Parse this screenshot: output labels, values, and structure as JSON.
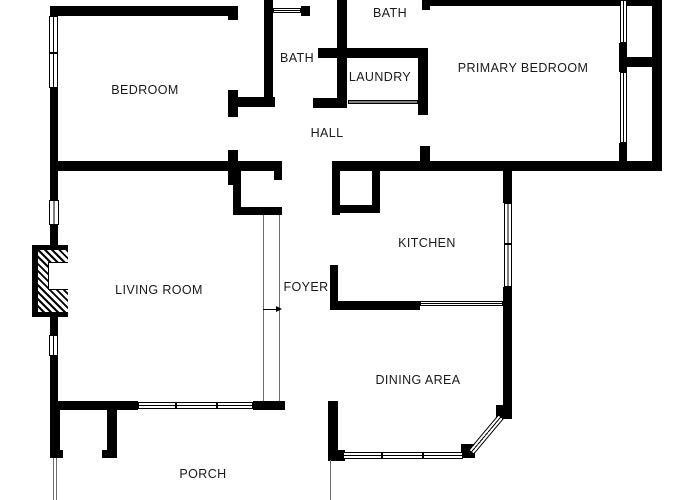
{
  "floorplan": {
    "canvas": {
      "width": 700,
      "height": 500,
      "background": "#ffffff",
      "wall_color": "#000000",
      "label_color": "#1a1a1a"
    },
    "rooms": [
      {
        "id": "bedroom",
        "label": "BEDROOM",
        "x": 145,
        "y": 90
      },
      {
        "id": "bath-hall",
        "label": "BATH",
        "x": 297,
        "y": 58
      },
      {
        "id": "bath-primary",
        "label": "BATH",
        "x": 390,
        "y": 13
      },
      {
        "id": "laundry",
        "label": "LAUNDRY",
        "x": 380,
        "y": 77
      },
      {
        "id": "primary-bedroom",
        "label": "PRIMARY BEDROOM",
        "x": 523,
        "y": 68
      },
      {
        "id": "hall",
        "label": "HALL",
        "x": 327,
        "y": 133
      },
      {
        "id": "kitchen",
        "label": "KITCHEN",
        "x": 427,
        "y": 243
      },
      {
        "id": "living-room",
        "label": "LIVING ROOM",
        "x": 159,
        "y": 290
      },
      {
        "id": "foyer",
        "label": "FOYER",
        "x": 306,
        "y": 287
      },
      {
        "id": "dining-area",
        "label": "DINING AREA",
        "x": 418,
        "y": 380
      },
      {
        "id": "porch",
        "label": "PORCH",
        "x": 203,
        "y": 474
      }
    ],
    "walls": [
      [
        50,
        6,
        188,
        10
      ],
      [
        228,
        10,
        10,
        10
      ],
      [
        50,
        88,
        8,
        76
      ],
      [
        50,
        161,
        232,
        10
      ],
      [
        50,
        171,
        8,
        29
      ],
      [
        50,
        225,
        8,
        22
      ],
      [
        50,
        315,
        8,
        20
      ],
      [
        50,
        356,
        8,
        49
      ],
      [
        228,
        150,
        10,
        35
      ],
      [
        264,
        0,
        9,
        103
      ],
      [
        301,
        6,
        9,
        10
      ],
      [
        337,
        0,
        10,
        108
      ],
      [
        318,
        48,
        107,
        10
      ],
      [
        313,
        98,
        34,
        10
      ],
      [
        233,
        97,
        42,
        10
      ],
      [
        228,
        90,
        10,
        27
      ],
      [
        418,
        48,
        10,
        67
      ],
      [
        422,
        0,
        8,
        10
      ],
      [
        420,
        146,
        10,
        25
      ],
      [
        332,
        161,
        330,
        10
      ],
      [
        427,
        0,
        235,
        6
      ],
      [
        652,
        0,
        10,
        171
      ],
      [
        625,
        57,
        37,
        10
      ],
      [
        619,
        43,
        8,
        29
      ],
      [
        619,
        143,
        8,
        28
      ],
      [
        233,
        171,
        8,
        44
      ],
      [
        233,
        207,
        49,
        8
      ],
      [
        274,
        168,
        8,
        12
      ],
      [
        332,
        171,
        8,
        44
      ],
      [
        372,
        165,
        8,
        48
      ],
      [
        332,
        205,
        48,
        8
      ],
      [
        330,
        265,
        8,
        45
      ],
      [
        330,
        301,
        90,
        9
      ],
      [
        503,
        163,
        9,
        40
      ],
      [
        503,
        287,
        9,
        128
      ],
      [
        328,
        401,
        10,
        60
      ],
      [
        336,
        450,
        9,
        11
      ],
      [
        50,
        401,
        88,
        9
      ],
      [
        253,
        401,
        32,
        9
      ],
      [
        107,
        402,
        10,
        56
      ],
      [
        50,
        405,
        10,
        53
      ],
      [
        50,
        450,
        13,
        8
      ],
      [
        102,
        450,
        15,
        8
      ],
      [
        461,
        444,
        14,
        14
      ],
      [
        496,
        405,
        16,
        14
      ]
    ],
    "windows": [
      {
        "x": 49,
        "y": 16,
        "w": 9,
        "h": 72,
        "dy": [
          52
        ],
        "dx": []
      },
      {
        "x": 49,
        "y": 200,
        "w": 10,
        "h": 25,
        "dy": [],
        "dx": []
      },
      {
        "x": 49,
        "y": 335,
        "w": 9,
        "h": 21,
        "dy": [],
        "dx": []
      },
      {
        "x": 504,
        "y": 203,
        "w": 8,
        "h": 84,
        "dy": [
          243
        ],
        "dx": []
      },
      {
        "x": 620,
        "y": 0,
        "w": 7,
        "h": 43,
        "dy": [],
        "dx": []
      },
      {
        "x": 620,
        "y": 72,
        "w": 7,
        "h": 71,
        "dy": [],
        "dx": []
      },
      {
        "x": 138,
        "y": 402,
        "w": 115,
        "h": 7,
        "dy": [],
        "dx": [
          175,
          216
        ]
      },
      {
        "x": 343,
        "y": 452,
        "w": 120,
        "h": 7,
        "dy": [],
        "dx": [
          381,
          422
        ]
      },
      {
        "x": 273,
        "y": 8,
        "w": 28,
        "h": 5,
        "dy": [],
        "dx": []
      },
      {
        "x": 348,
        "y": 100,
        "w": 70,
        "h": 4,
        "dy": [],
        "dx": []
      },
      {
        "x": 420,
        "y": 301,
        "w": 83,
        "h": 5,
        "dy": [],
        "dx": []
      }
    ],
    "bay_window": {
      "x": 471,
      "y": 449,
      "length": 47,
      "thickness": 7,
      "angle": -50
    },
    "rails": [
      {
        "x": 263,
        "y": 215,
        "len": 186
      },
      {
        "x": 279,
        "y": 215,
        "len": 186
      },
      {
        "x": 53,
        "y": 458,
        "len": 42
      },
      {
        "x": 56,
        "y": 458,
        "len": 42
      },
      {
        "x": 330,
        "y": 460,
        "len": 40
      }
    ],
    "entry_arrow": {
      "x": 263,
      "y": 309,
      "len": 13
    },
    "fireplace": {
      "outer": [
        32,
        245,
        36,
        72
      ],
      "hatch": [
        38,
        250,
        30,
        62
      ],
      "firebox": [
        48,
        262,
        20,
        28
      ]
    }
  }
}
